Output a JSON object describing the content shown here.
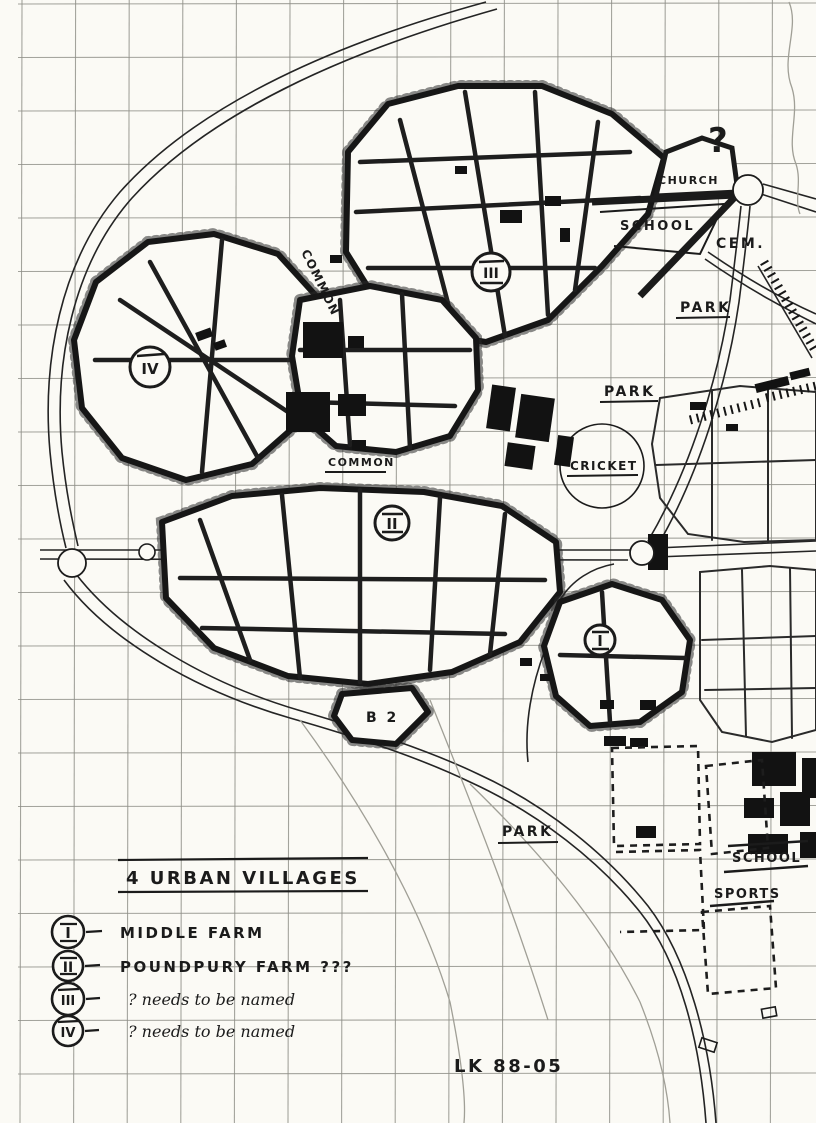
{
  "page": {
    "paper_color": "#fbfaf5",
    "grid_color": "#8e8e87",
    "ink_color": "#1b1b1b"
  },
  "map": {
    "labels": {
      "question_mark": "?",
      "church": "CHURCH",
      "school_top": "SCHOOL",
      "cem": "CEM.",
      "park_upper": "PARK",
      "park_mid": "PARK",
      "cricket": "CRICKET",
      "common_vertical": "COMMON",
      "common_horizontal": "COMMON",
      "b2": "B 2",
      "park_lower": "PARK",
      "school_lower": "SCHOOL",
      "sports": "SPORTS"
    },
    "village_markers": [
      {
        "numeral": "I"
      },
      {
        "numeral": "II"
      },
      {
        "numeral": "III"
      },
      {
        "numeral": "IV"
      }
    ]
  },
  "legend": {
    "title": "4 URBAN VILLAGES",
    "entries": [
      {
        "numeral": "I",
        "label": "MIDDLE FARM"
      },
      {
        "numeral": "II",
        "label": "POUNDPURY FARM ???"
      },
      {
        "numeral": "III",
        "label": "?  needs to be named"
      },
      {
        "numeral": "IV",
        "label": "?  needs to be named"
      }
    ],
    "signature": "LK 88-05"
  }
}
